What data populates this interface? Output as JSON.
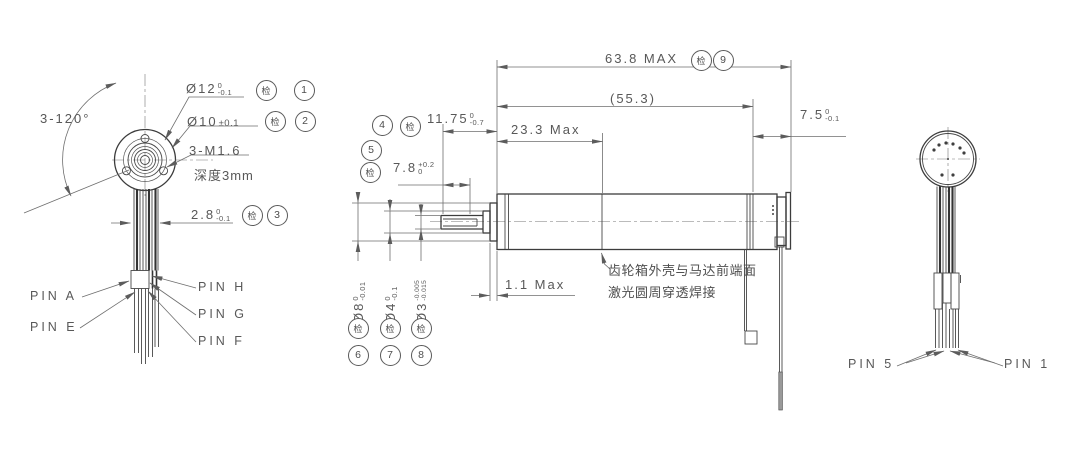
{
  "colors": {
    "background": "#ffffff",
    "object_line": "#3c3c3c",
    "dim_line": "#6e6e6e",
    "text": "#585858"
  },
  "front_view": {
    "angle_label": "3-120°",
    "dia12": {
      "value": "Ø12",
      "tol_top": "0",
      "tol_bot": "-0.1",
      "inspect": "检",
      "balloon": "1"
    },
    "dia10": {
      "value": "Ø10",
      "tol_inline": "±0.1",
      "inspect": "检",
      "balloon": "2"
    },
    "thread_label": "3-M1.6",
    "thread_depth": "深度3mm",
    "lead_width": {
      "value": "2.8",
      "tol_top": "0",
      "tol_bot": "-0.1",
      "inspect": "检",
      "balloon": "3"
    },
    "pin_labels": {
      "a": "PIN A",
      "e": "PIN E",
      "h": "PIN H",
      "g": "PIN G",
      "f": "PIN F"
    }
  },
  "side_view": {
    "overall_length": {
      "value": "63.8 MAX",
      "inspect": "检",
      "balloon": "9"
    },
    "ref_length": {
      "value": "(55.3)"
    },
    "gearbox_length": {
      "value": "23.3 Max"
    },
    "front_length": {
      "value": "11.75",
      "tol_top": "0",
      "tol_bot": "-0.7",
      "balloon": "4",
      "inspect": "检"
    },
    "shaft_length": {
      "value": "7.8",
      "tol_top": "+0.2",
      "tol_bot": "0",
      "balloon": "5",
      "inspect": "检"
    },
    "rear_length": {
      "value": "7.5",
      "tol_top": "0",
      "tol_bot": "-0.1"
    },
    "gap": {
      "value": "1.1 Max"
    },
    "dia8": {
      "value": "Ø8",
      "tol_top": "0",
      "tol_bot": "-0.01",
      "inspect": "检",
      "balloon": "6"
    },
    "dia4": {
      "value": "Ø4",
      "tol_top": "0",
      "tol_bot": "-0.1",
      "inspect": "检",
      "balloon": "7"
    },
    "dia3": {
      "value": "Ø3",
      "tol_top": "-0.005",
      "tol_bot": "-0.015",
      "inspect": "检",
      "balloon": "8"
    },
    "weld_note_line1": "齿轮箱外壳与马达前端面",
    "weld_note_line2": "激光圆周穿透焊接"
  },
  "rear_view": {
    "pin5": "PIN 5",
    "pin1": "PIN 1"
  }
}
